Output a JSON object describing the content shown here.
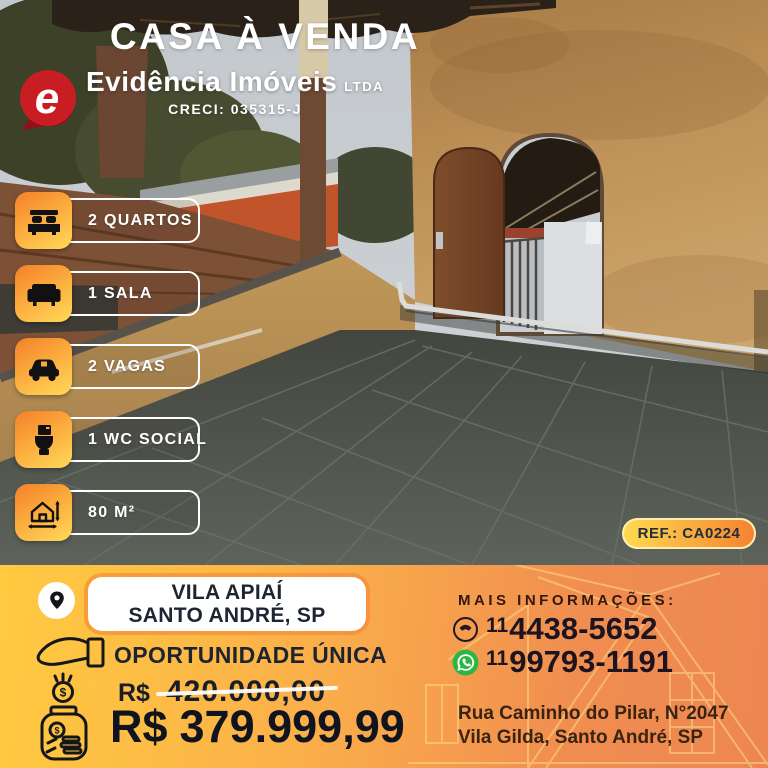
{
  "header": {
    "title": "CASA À VENDA"
  },
  "logo": {
    "emblem_letter": "e",
    "emblem_color": "#c81d23",
    "brand": "Evidência Imóveis",
    "suffix": "LTDA",
    "creci": "CRECI: 035315-J"
  },
  "features": [
    {
      "icon": "bed-icon",
      "label": "2 QUARTOS"
    },
    {
      "icon": "sofa-icon",
      "label": "1 SALA"
    },
    {
      "icon": "car-icon",
      "label": "2 VAGAS"
    },
    {
      "icon": "toilet-icon",
      "label": "1 WC SOCIAL"
    },
    {
      "icon": "area-icon",
      "label": "80 M²"
    }
  ],
  "ref_badge": {
    "label": "REF.: CA0224"
  },
  "footer": {
    "location_line1": "VILA APIAÍ",
    "location_line2": "SANTO ANDRÉ, SP",
    "opportunity": "OPORTUNIDADE ÚNICA",
    "old_price_currency": "R$",
    "old_price_value": "420.000,00",
    "new_price_currency": "R$",
    "new_price_value": "379.999,99",
    "info_heading": "MAIS INFORMAÇÕES:",
    "phone1_prefix": "11",
    "phone1_number": "4438-5652",
    "phone2_prefix": "11",
    "phone2_number": "99793-1191",
    "address_line1": "Rua Caminho do Pilar, N°2047",
    "address_line2": "Vila Gilda, Santo André, SP"
  },
  "colors": {
    "accent_orange": "#f5872c",
    "accent_yellow": "#ffd557",
    "band_left": "#ffca40",
    "band_right": "#ed8651",
    "whatsapp_green": "#2cb742",
    "emblem_red": "#c81d23",
    "text_dark": "#1d2430",
    "white": "#ffffff"
  }
}
